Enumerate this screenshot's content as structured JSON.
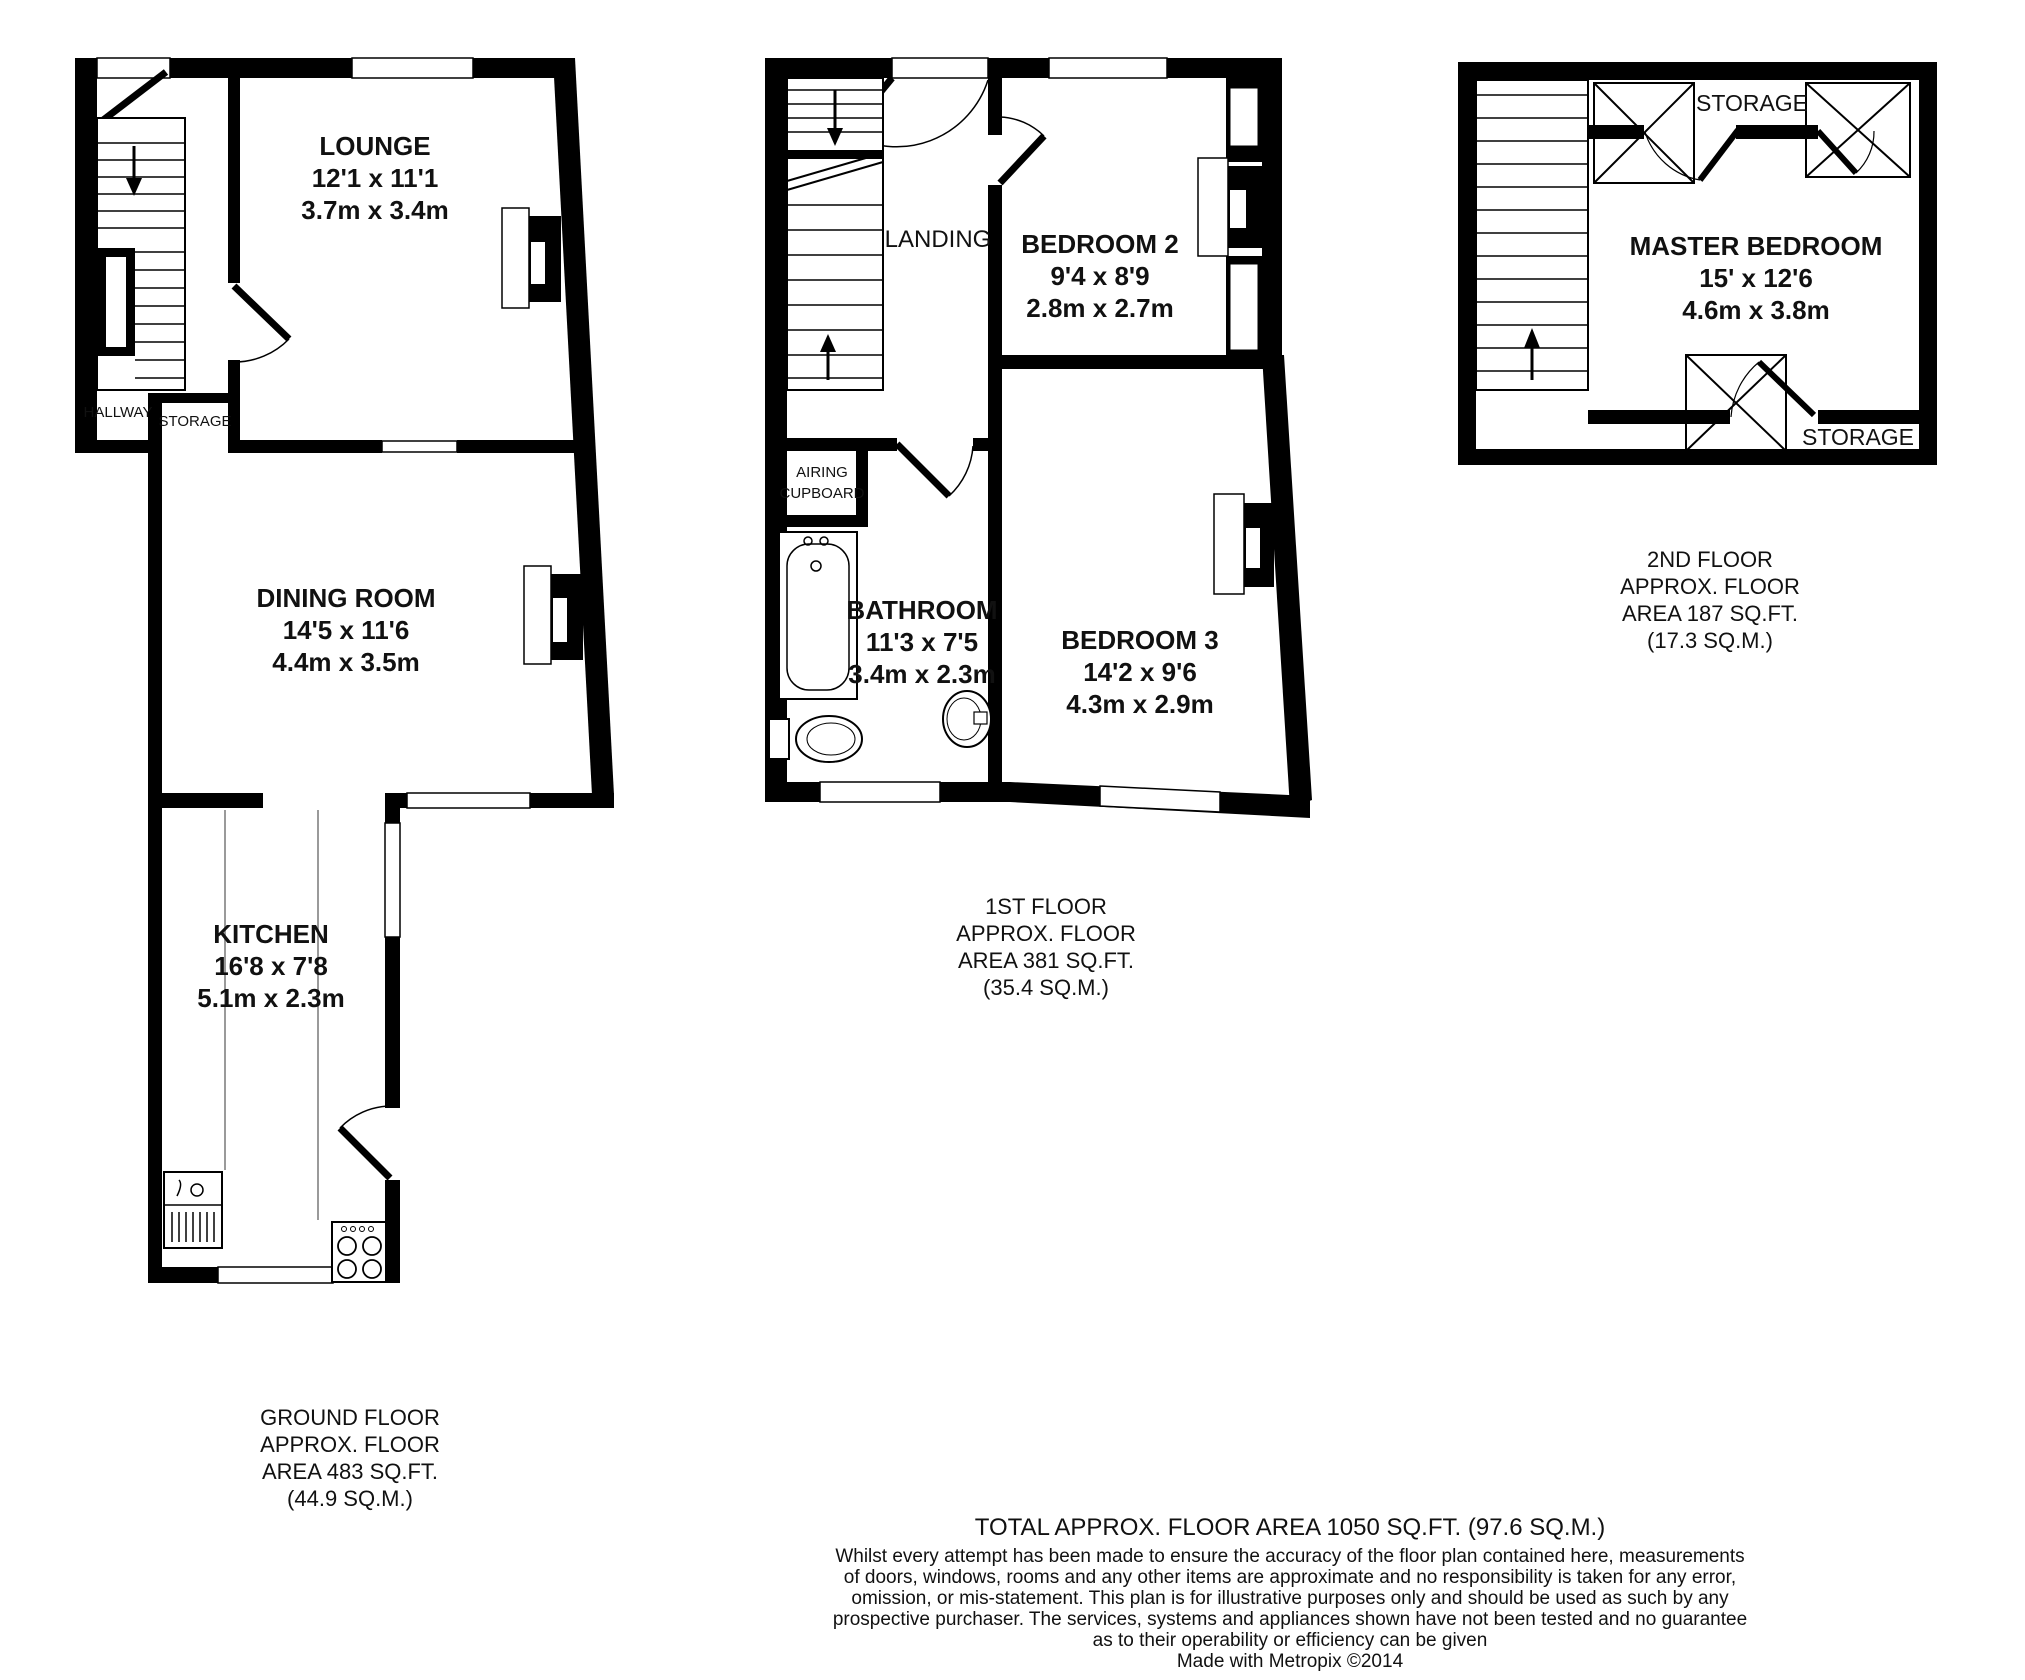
{
  "colors": {
    "wall": "#000000",
    "background": "#ffffff",
    "label": "#111111"
  },
  "floors": [
    {
      "name": "ground",
      "caption_lines": [
        "GROUND FLOOR",
        "APPROX. FLOOR",
        "AREA 483 SQ.FT.",
        "(44.9 SQ.M.)"
      ],
      "rooms": [
        {
          "name": "LOUNGE",
          "imperial": "12'1 x 11'1",
          "metric": "3.7m x 3.4m"
        },
        {
          "name": "DINING ROOM",
          "imperial": "14'5 x 11'6",
          "metric": "4.4m x 3.5m"
        },
        {
          "name": "KITCHEN",
          "imperial": "16'8 x 7'8",
          "metric": "5.1m x 2.3m"
        }
      ],
      "areas": [
        {
          "label": "HALLWAY"
        },
        {
          "label": "STORAGE"
        }
      ]
    },
    {
      "name": "first",
      "caption_lines": [
        "1ST FLOOR",
        "APPROX. FLOOR",
        "AREA 381 SQ.FT.",
        "(35.4 SQ.M.)"
      ],
      "rooms": [
        {
          "name": "BEDROOM 2",
          "imperial": "9'4 x 8'9",
          "metric": "2.8m x 2.7m"
        },
        {
          "name": "BATHROOM",
          "imperial": "11'3 x 7'5",
          "metric": "3.4m x 2.3m"
        },
        {
          "name": "BEDROOM 3",
          "imperial": "14'2 x 9'6",
          "metric": "4.3m x 2.9m"
        }
      ],
      "areas": [
        {
          "label": "LANDING"
        },
        {
          "label_lines": [
            "AIRING",
            "CUPBOARD"
          ]
        }
      ]
    },
    {
      "name": "second",
      "caption_lines": [
        "2ND FLOOR",
        "APPROX. FLOOR",
        "AREA 187 SQ.FT.",
        "(17.3 SQ.M.)"
      ],
      "rooms": [
        {
          "name": "MASTER BEDROOM",
          "imperial": "15' x 12'6",
          "metric": "4.6m x 3.8m"
        }
      ],
      "areas": [
        {
          "label": "STORAGE"
        },
        {
          "label": "STORAGE"
        }
      ]
    }
  ],
  "footer": {
    "total": "TOTAL APPROX. FLOOR AREA 1050 SQ.FT. (97.6 SQ.M.)",
    "disclaimer_lines": [
      "Whilst every attempt has been made to ensure the accuracy of the floor plan contained here, measurements",
      "of doors, windows, rooms and any other items are approximate and no responsibility is taken for any error,",
      "omission, or mis-statement. This plan is for illustrative purposes only and should be used as such by any",
      "prospective purchaser. The services, systems and appliances shown have not been tested and no guarantee",
      "as to their operability or efficiency can be given"
    ],
    "credit": "Made with Metropix ©2014"
  }
}
